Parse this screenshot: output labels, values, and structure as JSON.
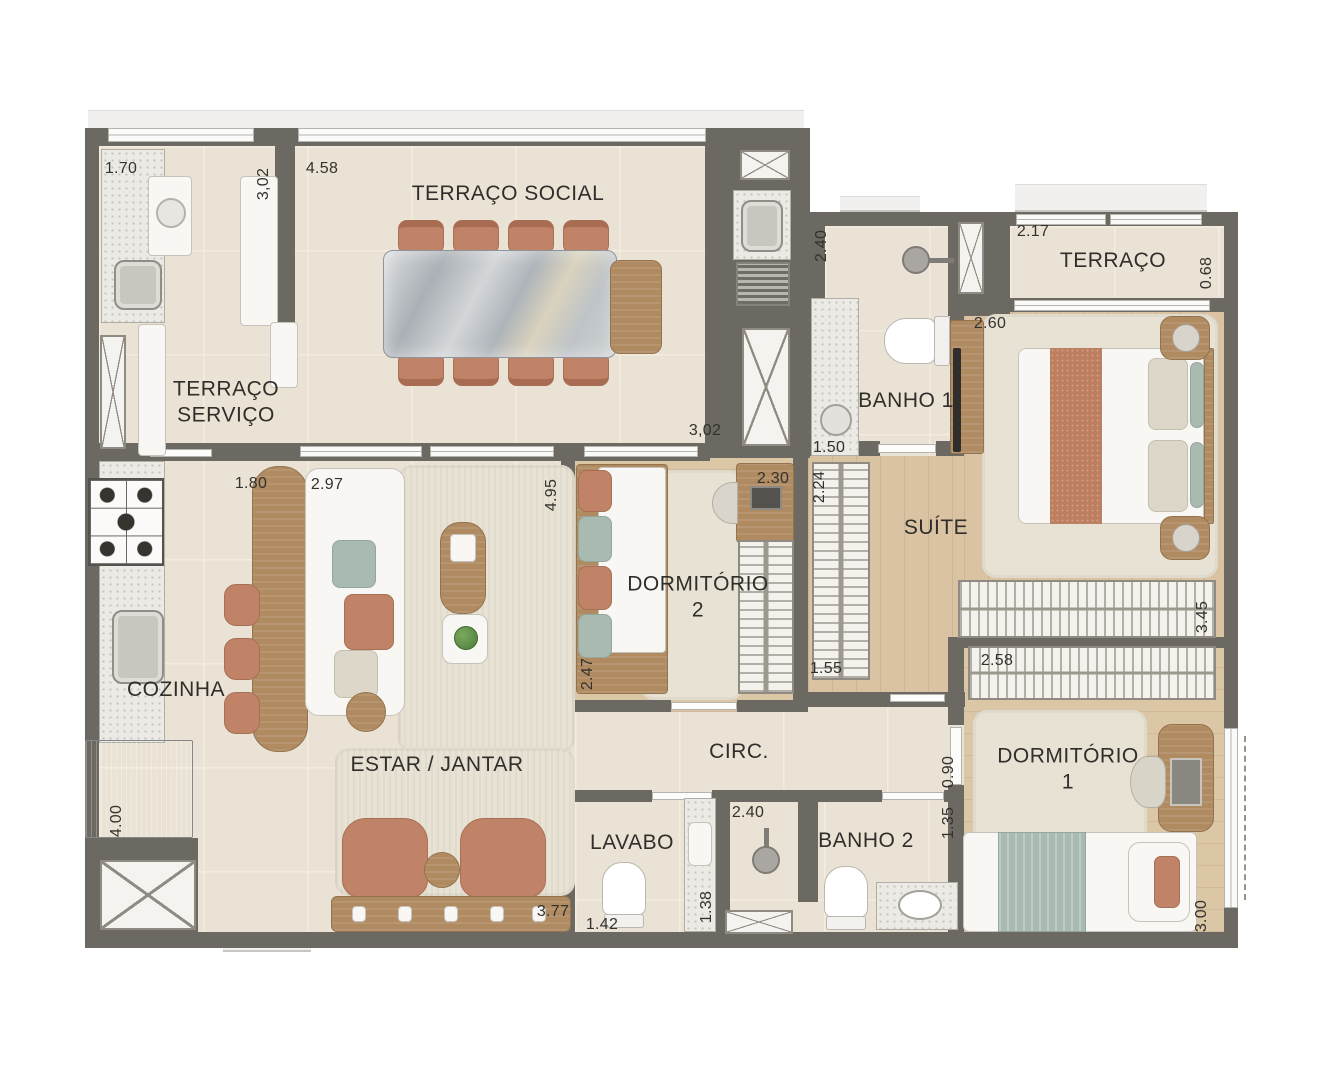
{
  "plan_title": "apartment-floor-plan",
  "rooms": [
    {
      "name": "terraco-social",
      "label": "TERRAÇO SOCIAL",
      "x": 508,
      "y": 194
    },
    {
      "name": "terraco-servico",
      "label": "TERRAÇO\nSERVIÇO",
      "x": 226,
      "y": 402
    },
    {
      "name": "terraco",
      "label": "TERRAÇO",
      "x": 1113,
      "y": 261
    },
    {
      "name": "banho-1",
      "label": "BANHO 1",
      "x": 906,
      "y": 401
    },
    {
      "name": "suite",
      "label": "SUÍTE",
      "x": 936,
      "y": 528
    },
    {
      "name": "dormitorio-2",
      "label": "DORMITÓRIO\n2",
      "x": 698,
      "y": 597
    },
    {
      "name": "dormitorio-1",
      "label": "DORMITÓRIO\n1",
      "x": 1068,
      "y": 769
    },
    {
      "name": "cozinha",
      "label": "COZINHA",
      "x": 176,
      "y": 690
    },
    {
      "name": "estar-jantar",
      "label": "ESTAR / JANTAR",
      "x": 437,
      "y": 765
    },
    {
      "name": "circ",
      "label": "CIRC.",
      "x": 739,
      "y": 752
    },
    {
      "name": "lavabo",
      "label": "LAVABO",
      "x": 632,
      "y": 843
    },
    {
      "name": "banho-2",
      "label": "BANHO 2",
      "x": 866,
      "y": 841
    }
  ],
  "dimensions": [
    {
      "label": "1.70",
      "x": 121,
      "y": 169,
      "vertical": false
    },
    {
      "label": "3,02",
      "x": 264,
      "y": 184,
      "vertical": true
    },
    {
      "label": "4.58",
      "x": 322,
      "y": 169,
      "vertical": false
    },
    {
      "label": "2.40",
      "x": 822,
      "y": 246,
      "vertical": true
    },
    {
      "label": "1.50",
      "x": 829,
      "y": 448,
      "vertical": false
    },
    {
      "label": "2.17",
      "x": 1033,
      "y": 232,
      "vertical": false
    },
    {
      "label": "0.68",
      "x": 1207,
      "y": 273,
      "vertical": true
    },
    {
      "label": "2.60",
      "x": 990,
      "y": 324,
      "vertical": false
    },
    {
      "label": "3,02",
      "x": 705,
      "y": 431,
      "vertical": false
    },
    {
      "label": "2.30",
      "x": 773,
      "y": 479,
      "vertical": false
    },
    {
      "label": "2.24",
      "x": 820,
      "y": 487,
      "vertical": true
    },
    {
      "label": "1.55",
      "x": 826,
      "y": 669,
      "vertical": false
    },
    {
      "label": "4.95",
      "x": 552,
      "y": 495,
      "vertical": true
    },
    {
      "label": "2.47",
      "x": 588,
      "y": 674,
      "vertical": true
    },
    {
      "label": "3.45",
      "x": 1203,
      "y": 617,
      "vertical": true
    },
    {
      "label": "2.58",
      "x": 997,
      "y": 661,
      "vertical": false
    },
    {
      "label": "1.80",
      "x": 251,
      "y": 484,
      "vertical": false
    },
    {
      "label": "2.97",
      "x": 327,
      "y": 485,
      "vertical": false
    },
    {
      "label": "0.90",
      "x": 949,
      "y": 772,
      "vertical": true
    },
    {
      "label": "1.35",
      "x": 949,
      "y": 823,
      "vertical": true
    },
    {
      "label": "2.40",
      "x": 748,
      "y": 813,
      "vertical": false
    },
    {
      "label": "1.42",
      "x": 602,
      "y": 925,
      "vertical": false
    },
    {
      "label": "1.38",
      "x": 707,
      "y": 907,
      "vertical": true
    },
    {
      "label": "3.77",
      "x": 553,
      "y": 912,
      "vertical": false
    },
    {
      "label": "4.00",
      "x": 117,
      "y": 821,
      "vertical": true
    },
    {
      "label": "3.00",
      "x": 1202,
      "y": 916,
      "vertical": true
    }
  ],
  "colors": {
    "wall": "#6c6862",
    "tile_floor": "#eae2d5",
    "wood_floor": "#d9c3a2",
    "rug": "#e8e2d4",
    "terracotta": "#c08367",
    "sage": "#a9bab0",
    "wood_furniture": "#b08b62",
    "marble": "#c2c6ca",
    "label_text": "#2f2e2a"
  }
}
